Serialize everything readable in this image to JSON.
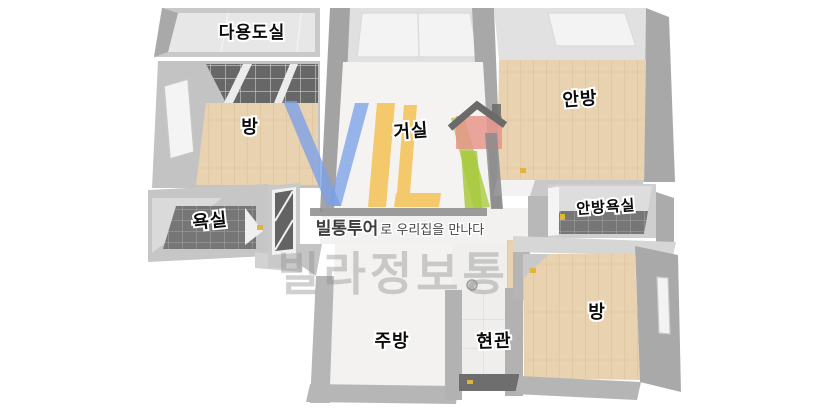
{
  "scene": {
    "description": "3D top-down apartment floor plan render with brand watermark",
    "background_color": "#ffffff"
  },
  "watermark": {
    "tagline_brand": "빌통투어",
    "tagline_rest": "로 우리집을 만나다",
    "brand_name": "빌라정보통",
    "colors": {
      "logo_blue": "#7ba0e8",
      "logo_yellow": "#f3bc45",
      "logo_green": "#a9c93e",
      "logo_red": "#e6958d",
      "logo_gray": "#8c8c8c"
    }
  },
  "floorplan": {
    "rooms": [
      {
        "id": "utility-room",
        "label": "다용도실"
      },
      {
        "id": "room-upper-left",
        "label": "방"
      },
      {
        "id": "living-room",
        "label": "거실"
      },
      {
        "id": "master-bedroom",
        "label": "안방"
      },
      {
        "id": "bathroom",
        "label": "욕실"
      },
      {
        "id": "master-bathroom",
        "label": "안방욕실"
      },
      {
        "id": "kitchen",
        "label": "주방"
      },
      {
        "id": "entrance",
        "label": "현관"
      },
      {
        "id": "room-lower-right",
        "label": "방"
      }
    ],
    "palette": {
      "wall": "#b9b9b9",
      "wall_light": "#dedede",
      "wood_floor": "#e9d2b0",
      "dark_tile": "#767676",
      "bright_floor": "#f3f2f0"
    }
  }
}
